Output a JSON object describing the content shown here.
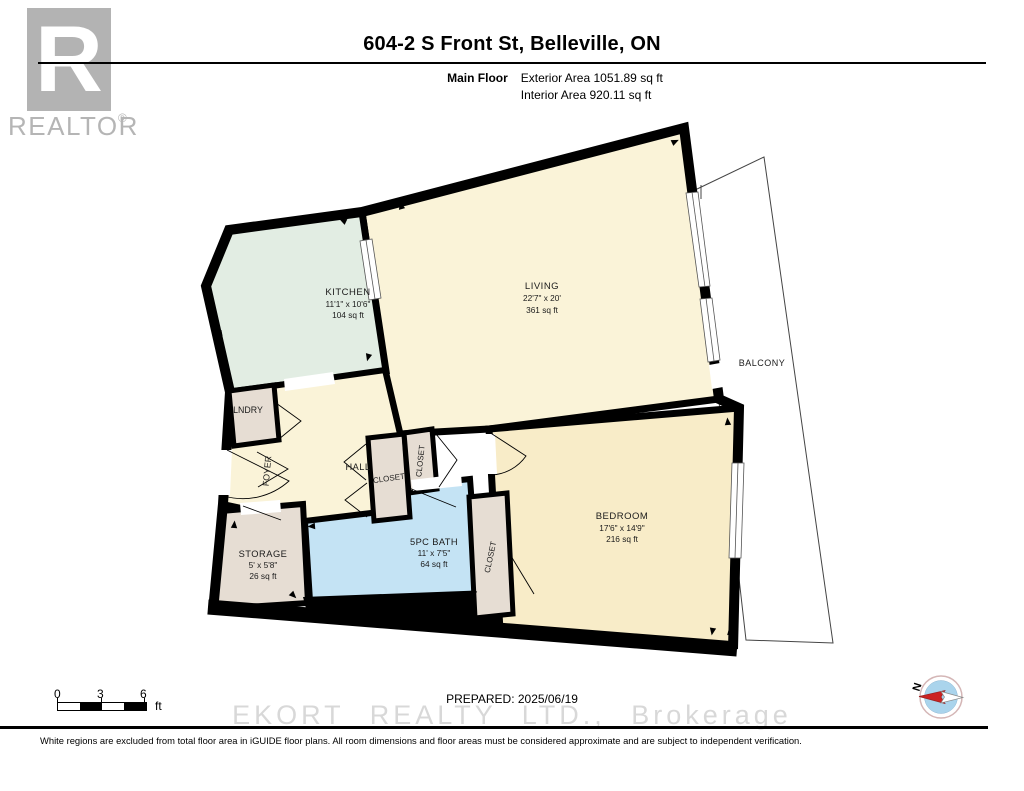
{
  "header": {
    "title": "604-2 S Front St, Belleville, ON",
    "floor_label": "Main Floor",
    "exterior_area": "Exterior Area 1051.89 sq ft",
    "interior_area": "Interior Area 920.11 sq ft"
  },
  "logo": {
    "letter": "R",
    "brand": "REALTOR",
    "reg": "®"
  },
  "rooms": {
    "kitchen": {
      "name": "KITCHEN",
      "dims": "11'1\" x 10'6\"",
      "area": "104 sq ft"
    },
    "living": {
      "name": "LIVING",
      "dims": "22'7\" x 20'",
      "area": "361 sq ft"
    },
    "balcony": {
      "name": "BALCONY"
    },
    "lndry": {
      "name": "LNDRY"
    },
    "foyer": {
      "name": "FOYER"
    },
    "hall": {
      "name": "HALL"
    },
    "closet_hall": {
      "name": "CLOSET"
    },
    "closet_hall2": {
      "name": "CLOSET"
    },
    "bath": {
      "name": "5PC BATH",
      "dims": "11' x 7'5\"",
      "area": "64 sq ft"
    },
    "closet_bedroom": {
      "name": "CLOSET"
    },
    "storage": {
      "name": "STORAGE",
      "dims": "5' x 5'8\"",
      "area": "26 sq ft"
    },
    "bedroom": {
      "name": "BEDROOM",
      "dims": "17'6\" x 14'9\"",
      "area": "216 sq ft"
    }
  },
  "scale_bar": {
    "tick0": "0",
    "tick3": "3",
    "tick6": "6",
    "unit": "ft"
  },
  "compass": {
    "north": "N"
  },
  "footer": {
    "prepared": "PREPARED: 2025/06/19",
    "watermark": "EKORT REALTY LTD., Brokerage",
    "disclaimer": "White regions are excluded from total floor area in iGUIDE floor plans. All room dimensions and floor areas must be considered approximate and are subject to independent verification."
  },
  "colors": {
    "wall": "#000000",
    "living": "#FAF3D8",
    "kitchen": "#E2EDE3",
    "bedroom": "#F8ECC8",
    "bath": "#C4E3F4",
    "tan": "#E6DDD3",
    "balcony": "#FFFFFF",
    "logo_gray": "#B3B3B3",
    "watermark_gray": "#D8D8D8",
    "compass_blue": "#AAD4EC",
    "compass_red": "#CC2222"
  }
}
